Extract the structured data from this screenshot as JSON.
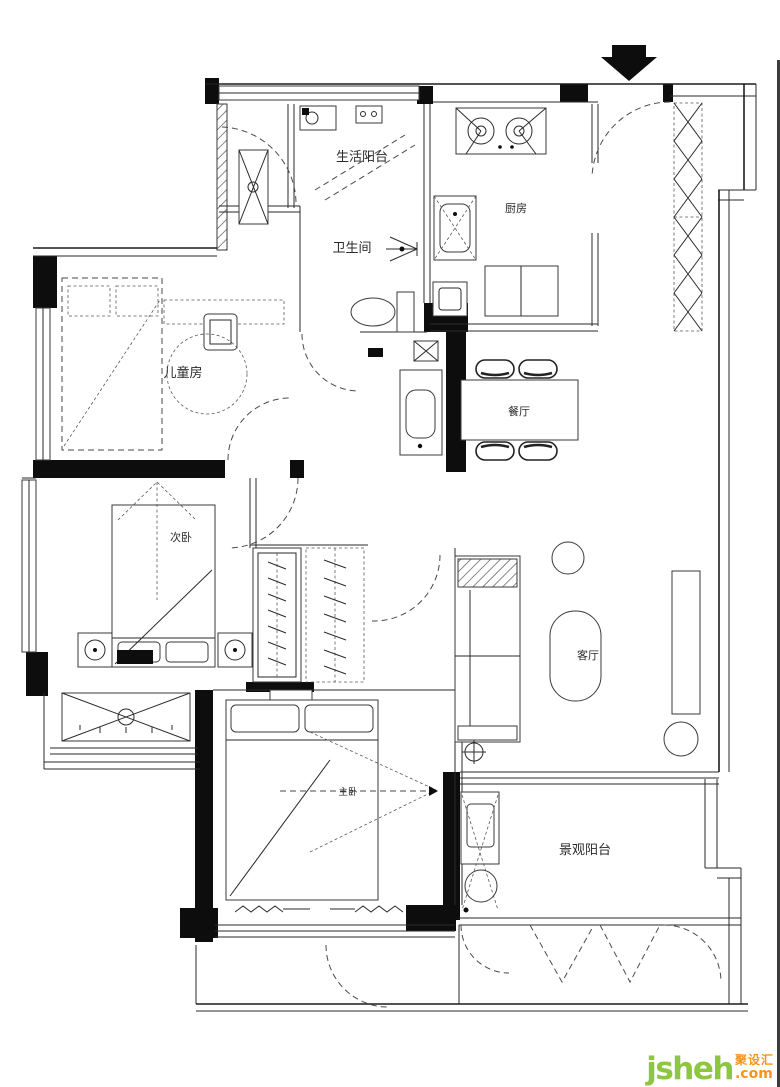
{
  "page": {
    "background": "#ffffff",
    "wall_color": "#0d0d0d",
    "line_color": "#2a2a2a"
  },
  "north_arrow": {
    "meaning": "entry-direction-arrow"
  },
  "rooms": {
    "service_balcony": {
      "label": "生活阳台"
    },
    "kitchen": {
      "label": "厨房"
    },
    "bathroom": {
      "label": "卫生间"
    },
    "kids_room": {
      "label": "儿童房"
    },
    "dining": {
      "label": "餐厅"
    },
    "second_bedroom": {
      "label": "次卧"
    },
    "living_room": {
      "label": "客厅"
    },
    "master_bedroom": {
      "label": "主卧"
    },
    "view_balcony": {
      "label": "景观阳台"
    }
  },
  "watermark": {
    "brand": "jsheh",
    "suffix": ".com",
    "chinese": "聚设汇",
    "brand_color": "#8dc63f",
    "accent_color": "#f7941e"
  }
}
